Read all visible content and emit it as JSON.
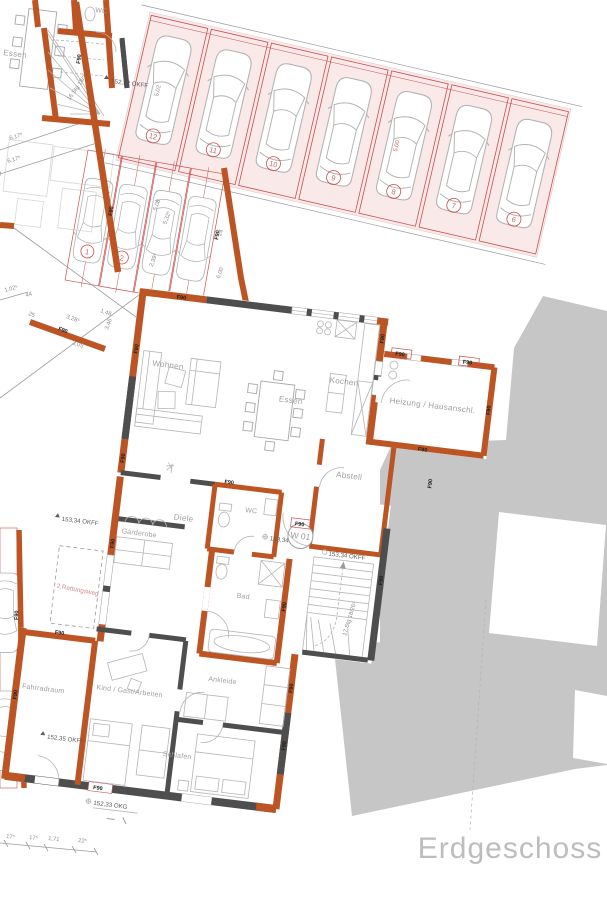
{
  "title": "Erdgeschoss",
  "plan": {
    "unit_label": "W 01",
    "fire_label": "F90",
    "escape_route_label": "2.Rettungsweg",
    "rooms": {
      "wohnen": "Wohnen",
      "essen": "Essen",
      "kochen": "Kochen",
      "heizung": "Heizung / Hausanschl.",
      "abstell": "Abstell",
      "wc": "WC",
      "diele": "Diele",
      "garderobe": "Garderobe",
      "bad": "Bad",
      "ankleide": "Ankleide",
      "schlafen": "Schlafen",
      "kind": "Kind / Gast/Arbeiten",
      "fahrradraum": "Fahrradraum"
    },
    "stair_label": "17 Stg 18/26⁵",
    "elevations": {
      "okff": "153,34 OKFF",
      "okff_low": "152,35 OKFF",
      "okg": "152,33 OKG"
    },
    "neighbor": {
      "essen": "Essen",
      "wc": "WC",
      "wohnen": "Wohnen",
      "stair_label": "16 Stg 18/27",
      "elevation": "152,32 OKFF"
    },
    "parking": {
      "top_row_numbers": [
        "12",
        "11",
        "10",
        "9",
        "8",
        "7",
        "6"
      ],
      "lower_numbers": [
        "1",
        "2"
      ],
      "stall_dims": [
        "5,02",
        "5,00"
      ],
      "lower_dims": [
        "5,08",
        "5,32⁵",
        "2,39⁵",
        "24",
        "6,00"
      ]
    },
    "dimensions": {
      "parcel": [
        "6,17⁵",
        "6,17⁵"
      ],
      "left": [
        "1,02⁵",
        "44",
        "25",
        "3,28⁵",
        "3,05",
        "3,46",
        "1,48"
      ],
      "bottom": [
        "17⁵",
        "17⁵",
        "1,71",
        "22⁵"
      ]
    },
    "colors": {
      "wall_fire": "#bd5423",
      "wall_concrete": "#4e4e4e",
      "parking_fill": "#f9e9e9",
      "parking_line": "#cc4c4c",
      "context_gray": "#c6c6c6",
      "room_label": "#9e9e9e",
      "red_label": "#cc6666",
      "title_gray": "#bdbdbd"
    }
  }
}
